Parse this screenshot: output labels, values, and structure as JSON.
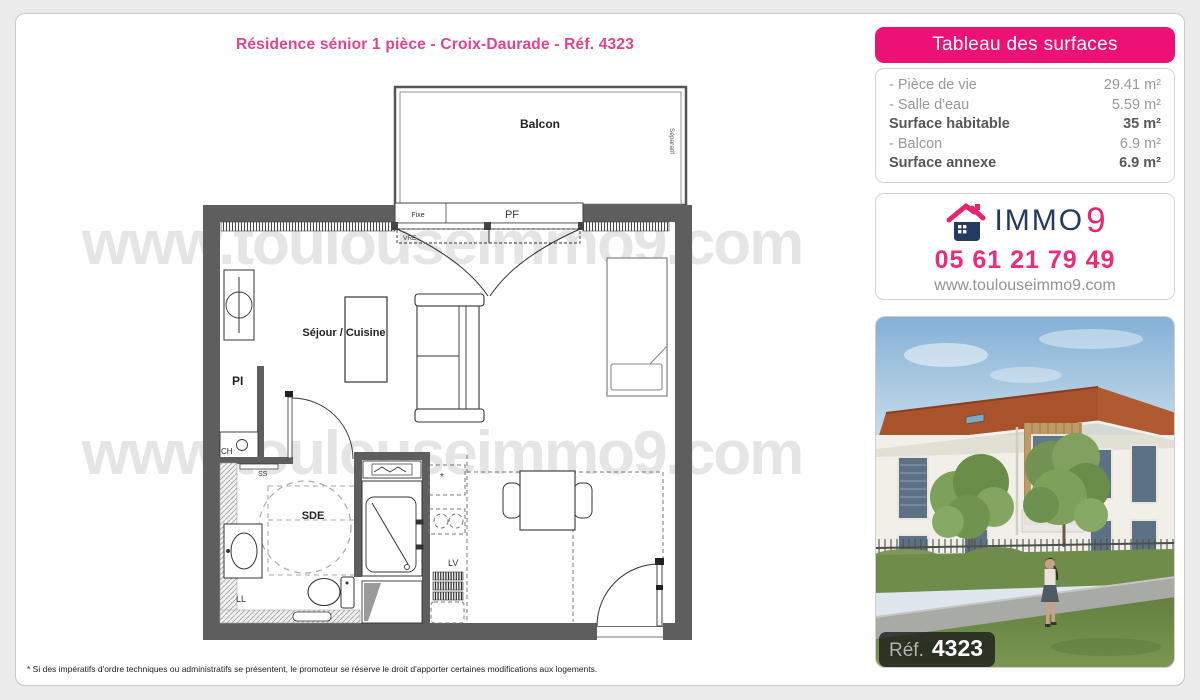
{
  "title": "Résidence sénior 1 pièce - Croix-Daurade - Réf. 4323",
  "watermark": {
    "line1": "www.toulouseimmo9.com",
    "line2": "www.toulouseimmo9.com"
  },
  "plan": {
    "labels": {
      "balcony": "Balcon",
      "separator": "Séparatif",
      "fixe": "Fixe",
      "pf": "PF",
      "vre": "VRE",
      "living": "Séjour / Cuisine",
      "pi": "PI",
      "ch": "CH",
      "ss": "SS",
      "sde": "SDE",
      "ll": "LL",
      "lv": "LV",
      "star": "*"
    }
  },
  "surfaces": {
    "header": "Tableau des surfaces",
    "rows": [
      {
        "label": "- Pièce de vie",
        "value": "29.41 m²"
      },
      {
        "label": "- Salle d'eau",
        "value": "5.59 m²"
      },
      {
        "label": "Surface habitable",
        "value": "35 m²"
      },
      {
        "label": "- Balcon",
        "value": "6.9 m²"
      },
      {
        "label": "Surface annexe",
        "value": "6.9 m²"
      }
    ]
  },
  "agency": {
    "brand_immo": "IMMO",
    "brand_9": "9",
    "phone": "05 61 21 79 49",
    "website": "www.toulouseimmo9.com"
  },
  "photo": {
    "ref_label": "Réf.",
    "ref_number": "4323"
  },
  "footnote": "* Si des impératifs d'ordre techniques ou administratifs se présentent, le promoteur se réserve le droit d'apporter certaines modifications aux logements."
}
